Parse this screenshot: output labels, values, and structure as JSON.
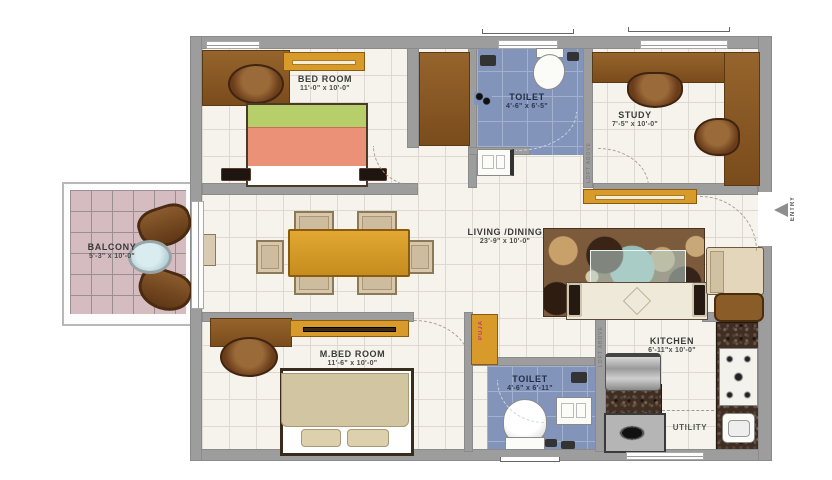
{
  "title": "apartment-floor-plan",
  "rooms": [
    {
      "id": "bedroom",
      "name": "BED ROOM",
      "dims": "11'-0\" x 10'-0\""
    },
    {
      "id": "toilet-top",
      "name": "TOILET",
      "dims": "4'-6\" x 6'-5\""
    },
    {
      "id": "study",
      "name": "STUDY",
      "dims": "7'-5\" x 10'-0\""
    },
    {
      "id": "balcony",
      "name": "BALCONY",
      "dims": "5'-3\" x 10'-0\""
    },
    {
      "id": "living",
      "name": "LIVING /DINING",
      "dims": "23'-9\" x 10'-0\""
    },
    {
      "id": "master-bedroom",
      "name": "M.BED ROOM",
      "dims": "11'-6\" x 10'-0\""
    },
    {
      "id": "toilet-bottom",
      "name": "TOILET",
      "dims": "4'-6\" x 6'-11\""
    },
    {
      "id": "kitchen",
      "name": "KITCHEN",
      "dims": "6'-11\"x 10'-0\""
    },
    {
      "id": "utility",
      "name": "UTILITY",
      "dims": ""
    }
  ],
  "annotations": {
    "entry": "ENTRY",
    "puja": "PUJA",
    "loft_study_wall": "LOFT ABOVE",
    "loft_kitchen_wall": "LOFT ABOVE"
  },
  "colors": {
    "wall": "#9d9d9d",
    "floor": "#f6f3ec",
    "toilet_floor": "#8294ba",
    "balcony_floor": "#d5bcc0",
    "wood": "#8a5a26",
    "gold_furniture": "#d79a2b",
    "bed_green": "#b7cf6b",
    "bed_salmon": "#ea9178",
    "bed_beige": "#d2c5a2",
    "puja_text": "#c23a6e"
  }
}
